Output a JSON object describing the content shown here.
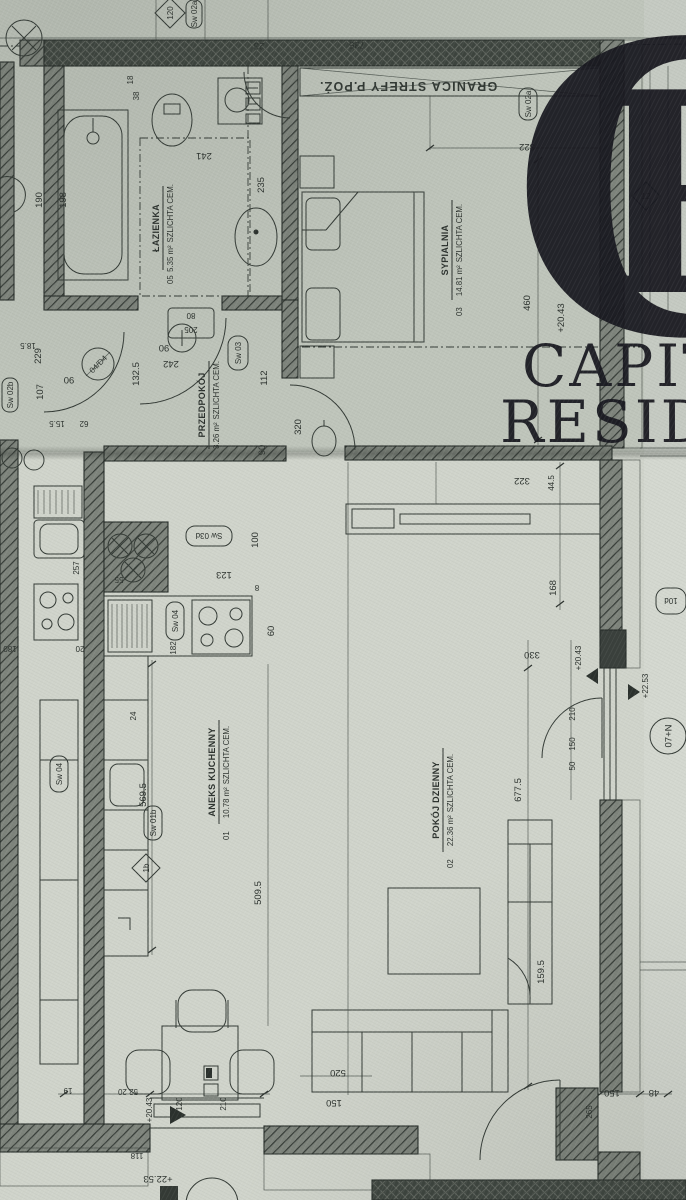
{
  "watermark": {
    "monogram_c": "C",
    "monogram_r": "R",
    "line1": "CAPITAL",
    "line2": "RESIDENCE",
    "ink": "#191920"
  },
  "plan": {
    "fire_boundary": "GRANICA STREFY P.POŻ.",
    "rooms": {
      "bath": {
        "num": "05",
        "name": "ŁAZIENKA",
        "area": "5.35 m²",
        "floor": "SZLICHTA CEM."
      },
      "bed": {
        "num": "03",
        "name": "SYPIALNIA",
        "area": "14.81 m²",
        "floor": "SZLICHTA CEM."
      },
      "hall": {
        "name": "PRZEDPOKÓJ",
        "area": "3.26 m²",
        "floor": "SZLICHTA CEM."
      },
      "kitchen": {
        "num": "01",
        "name": "ANEKS KUCHENNY",
        "area": "10.78 m²",
        "floor": "SZLICHTA CEM."
      },
      "living": {
        "num": "02",
        "name": "POKÓJ DZIENNY",
        "area": "22.36 m²",
        "floor": "SZLICHTA CEM."
      }
    },
    "tags": {
      "sw02a": "Sw 02a",
      "sw02b": "Sw 02b",
      "sw03": "Sw 03",
      "sw03d": "Sw 03d",
      "sw04": "Sw 04",
      "sw01b": "Sw 01b",
      "d120": "120",
      "d12": "12",
      "d1b": "1b",
      "t10": "10d",
      "door80": "80",
      "door205": "205",
      "doorD4": "04/D4"
    },
    "axis": {
      "a07": "07+N"
    },
    "levels": {
      "a": "+20.43",
      "b": "+22.53"
    },
    "dims": {
      "d735": "735",
      "d23": "23",
      "d322": "322",
      "d460": "460",
      "d112": "112",
      "d320": "320",
      "d242": "242",
      "d90": "90",
      "d1325": "132.5",
      "d107": "107",
      "d229": "229",
      "d185": "18.5",
      "d155": "15.5",
      "d62": "62",
      "d38": "38",
      "d18": "18",
      "d241": "241",
      "d198": "198",
      "d190": "190",
      "d235": "235",
      "d123": "123",
      "d100": "100",
      "d8": "8",
      "d55": "55",
      "d60": "60",
      "d182": "182",
      "d24": "24",
      "d5695": "569.5",
      "d5095": "509.5",
      "d6775": "677.5",
      "d330": "330",
      "d445": "44.5",
      "d168": "168",
      "d1595": "159.5",
      "d210": "210",
      "d150": "150",
      "d50": "50",
      "d5220": "52 20",
      "d19": "19",
      "d120": "120",
      "d520": "520",
      "d48": "48",
      "d265": "265",
      "d118": "118",
      "d257": "257",
      "d180": "180",
      "d20": "20"
    }
  }
}
